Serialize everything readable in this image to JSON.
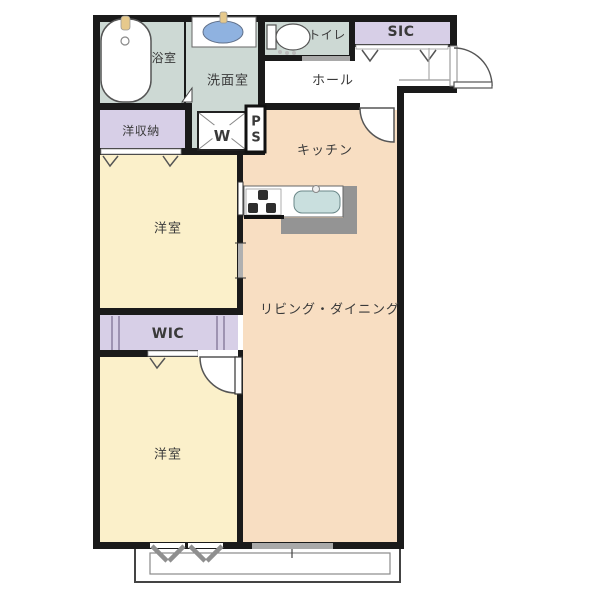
{
  "plan": {
    "rooms": {
      "bathroom": "浴室",
      "washroom": "洗面室",
      "toilet": "トイレ",
      "sic": "SIC",
      "hall": "ホール",
      "storage": "洋収納",
      "kitchen": "キッチン",
      "bedroom_upper": "洋室",
      "wic": "WIC",
      "living_dining": "リビング・ダイニング",
      "bedroom_lower": "洋室",
      "washer": "W",
      "pipe_space_p": "P",
      "pipe_space_s": "S"
    },
    "colors": {
      "wall": "#1a1a1a",
      "wet_area": "#cdd9d4",
      "closet": "#d7cfe7",
      "bedroom": "#fbf0ca",
      "living": "#f8dec2",
      "counter_gray": "#949494",
      "basin_blue": "#8fb2e0",
      "sink_teal": "#c9dfde",
      "slider_gray": "#a9a9a9",
      "fixture_line": "#555555",
      "faucet_beige": "#e6c98c"
    }
  }
}
